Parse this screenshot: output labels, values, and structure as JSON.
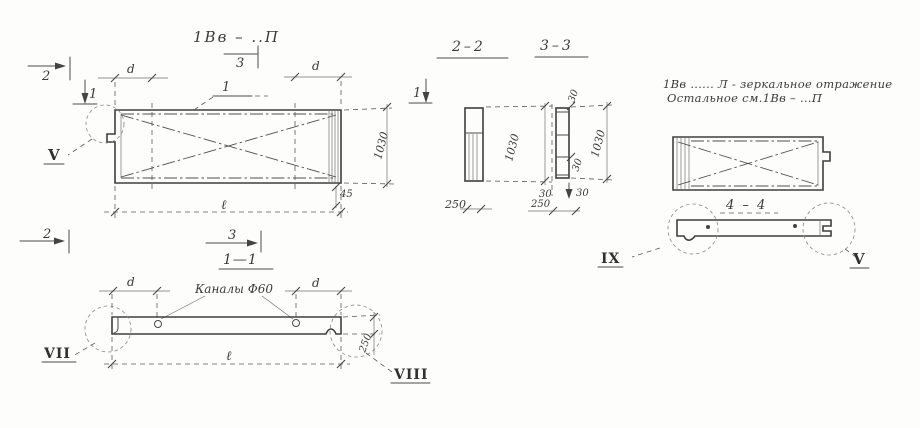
{
  "main_view": {
    "title": "1Вв – ..П",
    "item_callout": "1",
    "mark_2_top": "2",
    "mark_1": "1",
    "mark_3_top": "3",
    "mark_2_bottom": "2",
    "mark_3_bottom": "3",
    "dim_d_left": "d",
    "dim_d_right": "d",
    "dim_height": "1030",
    "dim_45": "45",
    "dim_length": "ℓ",
    "detail_v": "V"
  },
  "section_2_2": {
    "title": "2–2",
    "mark_1": "1",
    "dim_height": "1030",
    "dim_width": "250"
  },
  "section_3_3": {
    "title": "3–3",
    "dim_top": "30",
    "dim_height": "1030",
    "dim_mid": "30",
    "dim_bottom_left": "30",
    "dim_bottom_right": "30",
    "dim_width": "250"
  },
  "mirror_note": {
    "line1": "1Вв ...... Л - зеркальное отражение",
    "line2": "Остальное см.1Вв – ...П"
  },
  "section_4_4": {
    "title": "4 – 4",
    "detail_ix": "IX",
    "detail_v": "V"
  },
  "section_1_1": {
    "title": "1—1",
    "channels": "Каналы Ф60",
    "dim_d_left": "d",
    "dim_d_right": "d",
    "dim_length": "ℓ",
    "dim_height": "250",
    "detail_vii": "VII",
    "detail_viii": "VIII"
  }
}
